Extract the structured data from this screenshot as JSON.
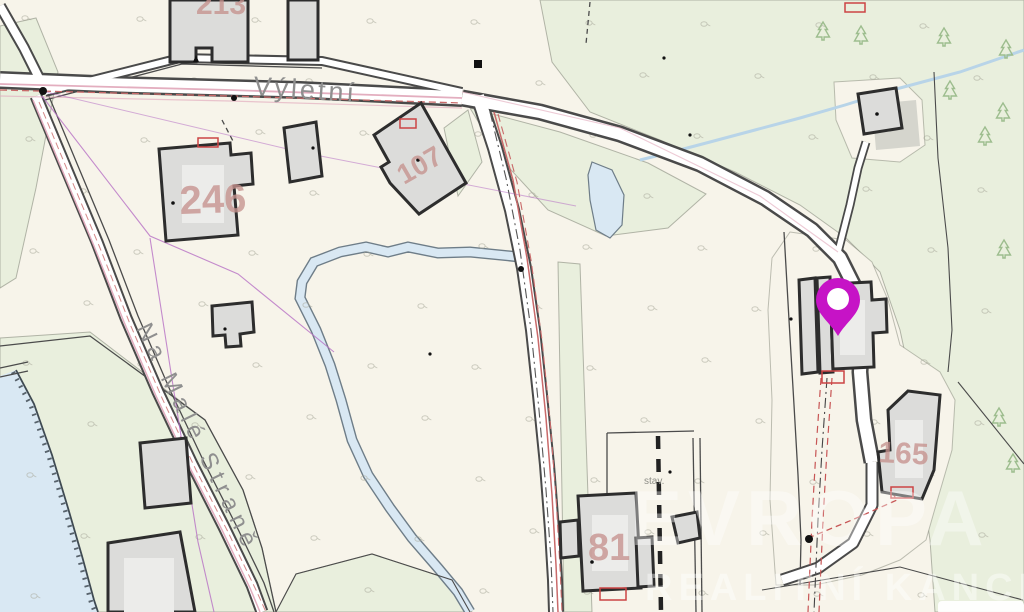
{
  "map": {
    "title": "cadastral-map",
    "street_labels": {
      "vyletni": "Výletní",
      "na_male_strane": "Na Malé Straně"
    },
    "parcel_numbers": {
      "p213": "213",
      "p246": "246",
      "p107": "107",
      "p81": "81",
      "p165": "165"
    },
    "small_labels": {
      "stav": "stav."
    },
    "watermark": {
      "line1": "EVROPA",
      "line2": "REALITNÍ KANCELÁŘ"
    },
    "marker": {
      "name": "location-pin",
      "color": "#c613c6"
    },
    "colors": {
      "background": "#f7f4ea",
      "green_area": "#e9efdd",
      "water": "#d9e8f3",
      "road_fill": "#ffffff",
      "road_casing": "#4a4a4a",
      "building_fill": "#dcdcda",
      "building_outline": "#2d2d2d",
      "parcel_number": "#c6928e",
      "street_label": "#8f8f8f",
      "utility_pink": "#e3aebf",
      "utility_red": "#c96a6a",
      "magenta_line": "#b76fc4",
      "tree_green": "#9dbd8e"
    },
    "trees": [
      [
        823,
        38
      ],
      [
        861,
        42
      ],
      [
        944,
        44
      ],
      [
        1006,
        56
      ],
      [
        950,
        97
      ],
      [
        1003,
        119
      ],
      [
        985,
        143
      ],
      [
        1004,
        256
      ],
      [
        999,
        424
      ],
      [
        1013,
        470
      ]
    ],
    "grass_grid": {
      "x_start": 30,
      "x_step": 56,
      "x_end": 1014,
      "y_start": 22,
      "y_step": 57,
      "y_end": 600
    }
  }
}
